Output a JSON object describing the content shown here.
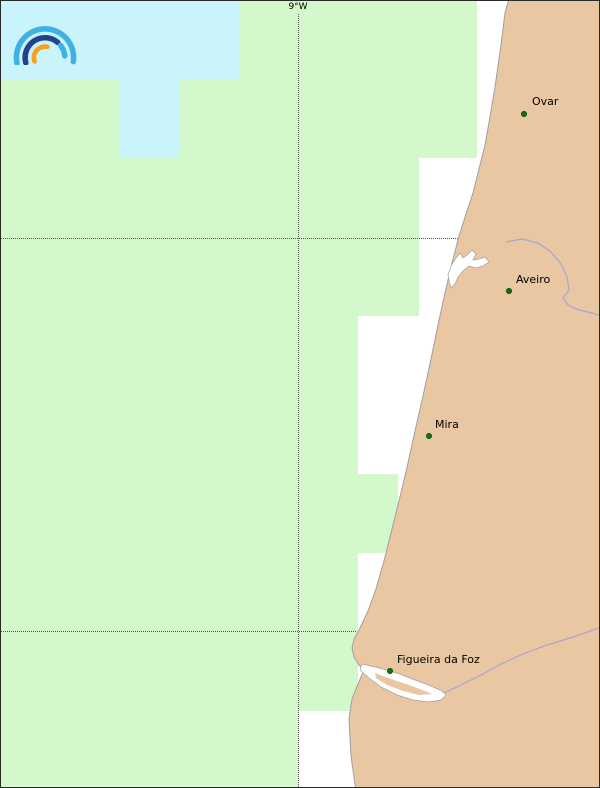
{
  "map": {
    "region_label": "coastal-map-portugal",
    "graticule": {
      "meridian": {
        "label": "9°W",
        "x": 297,
        "label_top": 1,
        "line_top": 13,
        "line_bottom": 788
      },
      "parallels": [
        {
          "y": 237,
          "x_start": 0,
          "x_end": 457
        },
        {
          "y": 630,
          "x_start": 0,
          "x_end": 355
        }
      ]
    },
    "cities": [
      {
        "name": "Ovar",
        "dot_x": 523,
        "dot_y": 113,
        "label_x": 531,
        "label_y": 94
      },
      {
        "name": "Aveiro",
        "dot_x": 508,
        "dot_y": 290,
        "label_x": 515,
        "label_y": 272
      },
      {
        "name": "Mira",
        "dot_x": 428,
        "dot_y": 435,
        "label_x": 434,
        "label_y": 417
      },
      {
        "name": "Figueira da Foz",
        "dot_x": 389,
        "dot_y": 670,
        "label_x": 396,
        "label_y": 652
      }
    ],
    "coverage_cells": {
      "high": [
        [
          0,
          0,
          238,
          78
        ],
        [
          119,
          78,
          59,
          79
        ]
      ],
      "low": [
        [
          0,
          78,
          298,
          710
        ],
        [
          238,
          0,
          60,
          78
        ],
        [
          298,
          0,
          178,
          157
        ],
        [
          298,
          157,
          120,
          158
        ],
        [
          298,
          315,
          59,
          158
        ],
        [
          298,
          473,
          99,
          79
        ],
        [
          298,
          552,
          59,
          158
        ]
      ]
    },
    "colors": {
      "sea": "#ffffff",
      "coverage_low": "#d2f8cc",
      "coverage_high": "#c9f4fb",
      "land": "#eac7a3",
      "coast": "#a0a0a0",
      "river": "#a5a5cd",
      "water_body": "#ffffff",
      "grid": "#555555",
      "city_dot": "#0b7a0b",
      "label": "#000000"
    }
  },
  "logo": {
    "name": "rainbow-arcs-logo",
    "colors": {
      "outer_arc": "#3fb2e5",
      "middle_arc": "#24418e",
      "inner_arc": "#f8a01e"
    }
  }
}
